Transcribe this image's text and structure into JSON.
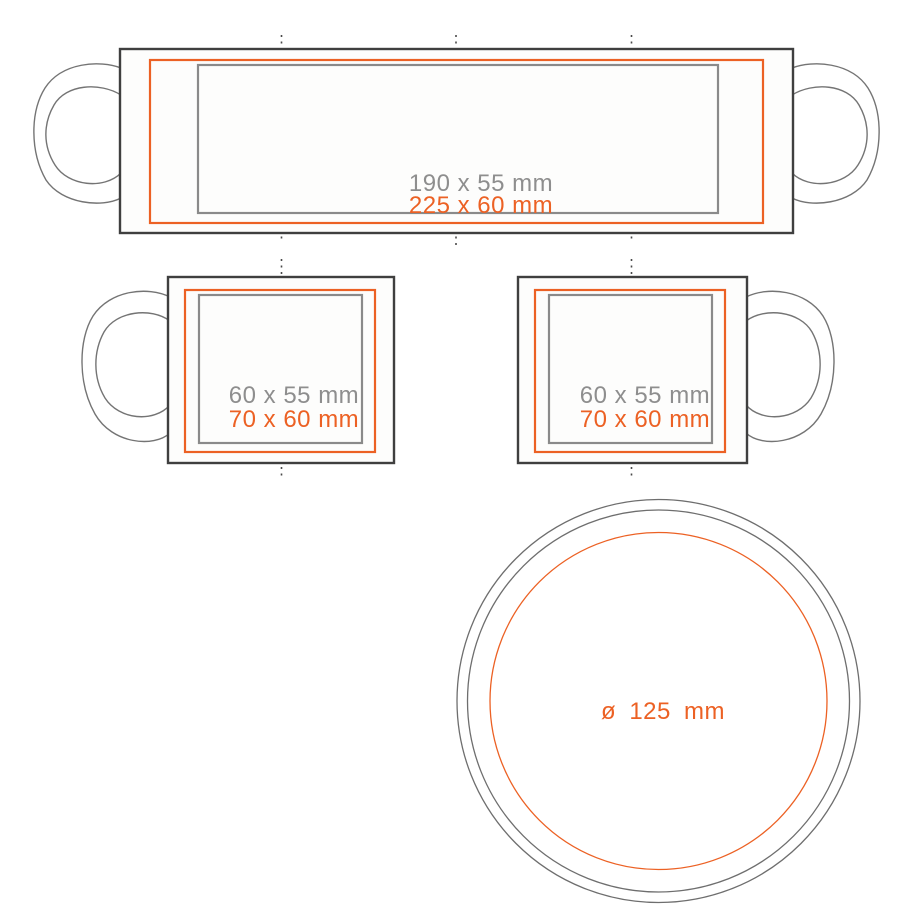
{
  "page": {
    "background": "#FFFFFF"
  },
  "colors": {
    "accent_orange": "#EC6124",
    "dimension_gray": "#8E8E8E",
    "body_outline_dark": "#3F3F3F",
    "thin_line_gray": "#6E6E6E",
    "guide_dot_gray": "#4A4A4A"
  },
  "views": {
    "wrap": {
      "print_area_label": "190 x 55 mm",
      "max_area_label": "225 x 60 mm"
    },
    "side_left": {
      "print_area_label": "60 x 55 mm",
      "max_area_label": "70 x 60 mm"
    },
    "side_right": {
      "print_area_label": "60 x 55 mm",
      "max_area_label": "70 x 60 mm"
    },
    "top": {
      "diameter_label": "ø 125 mm"
    }
  }
}
